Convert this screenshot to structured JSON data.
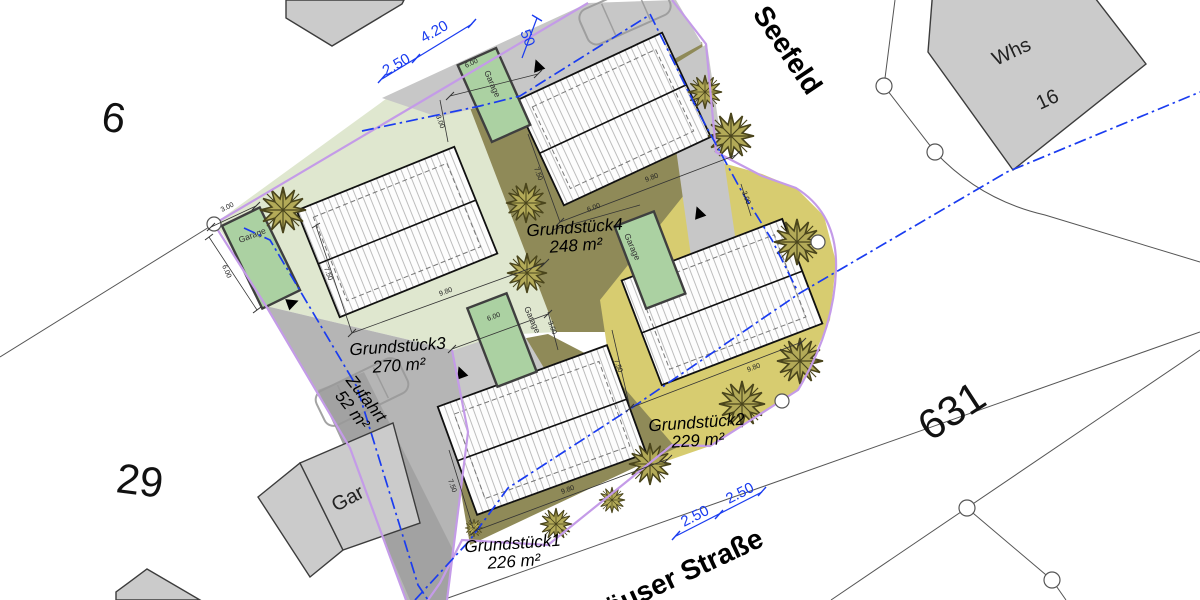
{
  "streets": {
    "seefeld": "Seefeld",
    "strasse": "häuser Straße"
  },
  "parcels": {
    "p6": "6",
    "p29": "29",
    "p631": "631"
  },
  "buildings": {
    "whs": "Whs",
    "whs_no": "16",
    "gar": "Gar"
  },
  "plots": {
    "g1": {
      "name": "Grundstück1",
      "area": "226 m²"
    },
    "g2": {
      "name": "Grundstück2",
      "area": "229 m²"
    },
    "g3": {
      "name": "Grundstück3",
      "area": "270 m²"
    },
    "g4": {
      "name": "Grundstück4",
      "area": "248 m²"
    },
    "zufahrt": {
      "name": "Zufahrt",
      "area": "52 m²"
    }
  },
  "garage_label": "Garage",
  "dims_blue": {
    "d250": "2.50",
    "d420": "4.20",
    "d50": "50"
  },
  "dims": {
    "d980": "9.80",
    "d600": "6.00",
    "d300": "3.00",
    "d750": "7.50"
  },
  "colors": {
    "plot_pale": "#dfe7cf",
    "plot_olive": "#8f8a58",
    "plot_yellow": "#d7cc70",
    "garage_green": "#abd1a2",
    "drive_gray": "#c7c7c7",
    "boundary_violet": "#c49be8",
    "dim_blue": "#1a3cf0"
  }
}
